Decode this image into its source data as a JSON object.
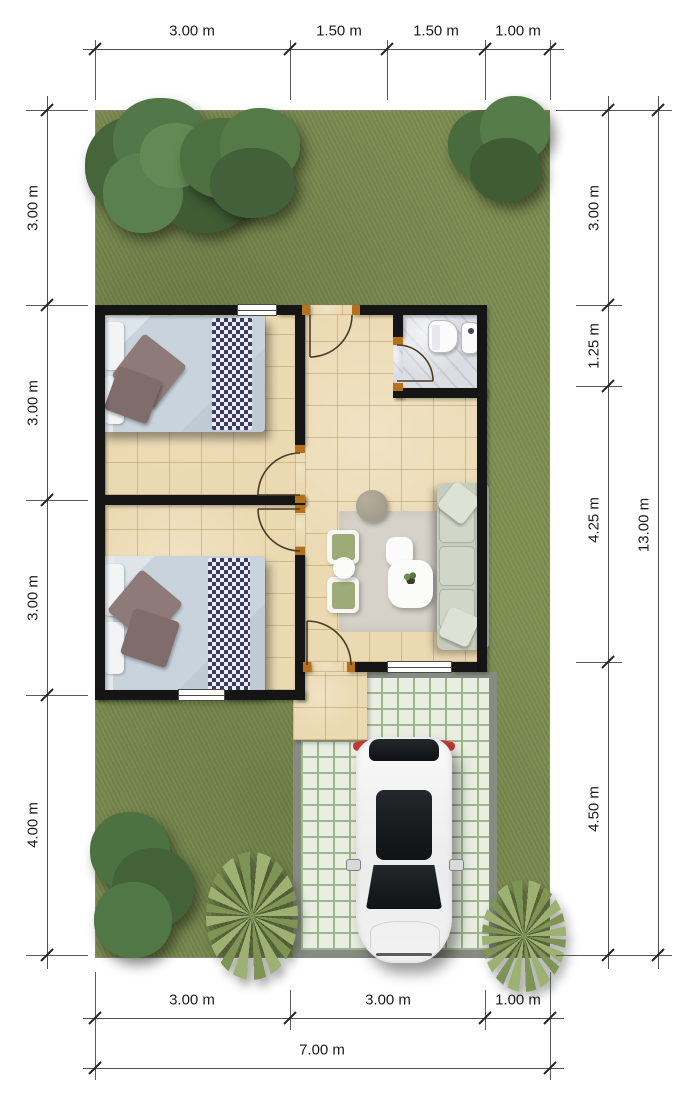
{
  "plan": {
    "units": "m",
    "plot_width_label": "7.00 m",
    "plot_height_label": "13.00 m"
  },
  "dimensions": {
    "top": [
      {
        "label": "3.00 m"
      },
      {
        "label": "1.50 m"
      },
      {
        "label": "1.50 m"
      },
      {
        "label": "1.00 m"
      }
    ],
    "left": [
      {
        "label": "3.00 m"
      },
      {
        "label": "3.00 m"
      },
      {
        "label": "3.00 m"
      },
      {
        "label": "4.00 m"
      }
    ],
    "right": [
      {
        "label": "3.00 m"
      },
      {
        "label": "1.25 m"
      },
      {
        "label": "4.25 m"
      },
      {
        "label": "4.50 m"
      }
    ],
    "right_total": {
      "label": "13.00 m"
    },
    "bottom": [
      {
        "label": "3.00 m"
      },
      {
        "label": "3.00 m"
      },
      {
        "label": "1.00 m"
      }
    ],
    "bottom_total": {
      "label": "7.00 m"
    }
  },
  "colors": {
    "grass": "#7b8c50",
    "wall": "#151515",
    "floor_tile": "#ebd9b1",
    "bathroom_floor": "#dcdde3",
    "paver": "#e9ede2",
    "paver_joint": "#9fb68c",
    "door_frame": "#b5701d",
    "dimension_line": "#4f4f4f",
    "car": "#f2f2f2",
    "sofa": "#c6ccbe",
    "bed_blanket_check": "#3c3d5e"
  }
}
